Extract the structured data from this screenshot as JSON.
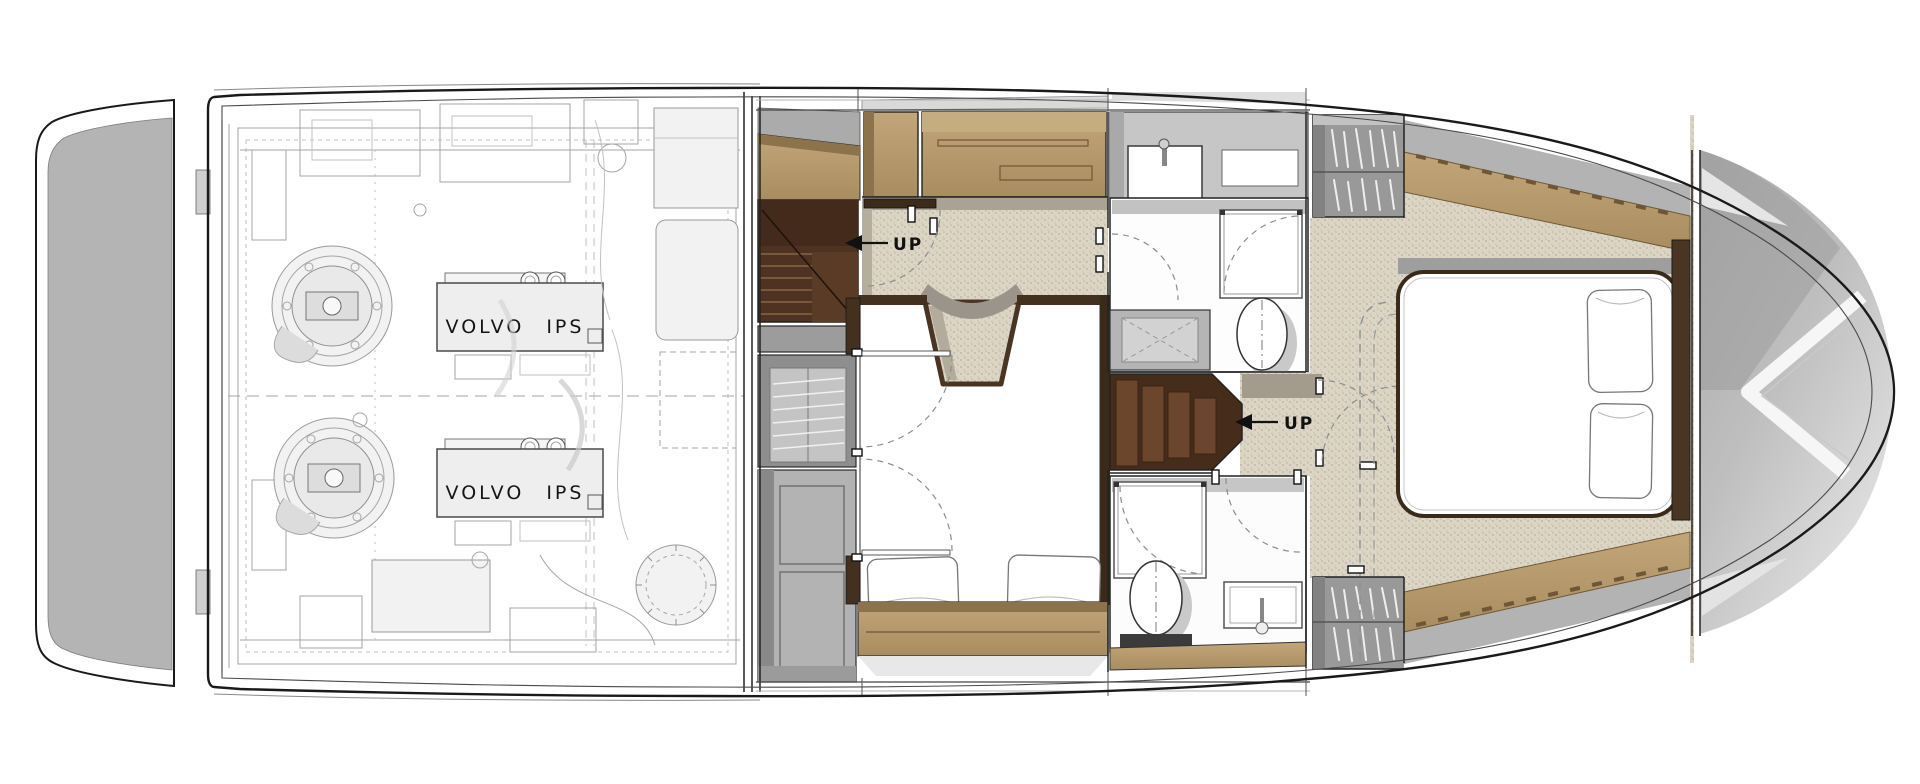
{
  "plan": {
    "engine_room": {
      "engine_port_label": "VOLVO IPS",
      "engine_starboard_label": "VOLVO IPS"
    },
    "aft_stairs": {
      "up_label": "UP"
    },
    "forward_stairs": {
      "up_label": "UP"
    }
  },
  "palette": {
    "hull_outline": "#1a1a1a",
    "platform_gray": "#b4b4b4",
    "carpet_beige": "#dcd5c6",
    "wood_tan": "#b2976b",
    "wood_dark_edge": "#8d734c",
    "dark_wood_wall": "#43301f",
    "stair_wood_dark": "#4e3322",
    "stair_wood_light": "#6b452c",
    "cabinet_gray": "#a8a8a8",
    "linework_gray": "#a6a6a6",
    "bow_shadow_gray": "#9c9c9c"
  },
  "icons": {
    "up_arrow": "solid left-pointing triangle with leader line",
    "hanger_rods": "slanted white rods in wardrobe",
    "toilet": "oval bowl with dash-dot centerline",
    "shower": "square tray with dashed swing arc",
    "sink": "rectangular basin with faucet"
  }
}
